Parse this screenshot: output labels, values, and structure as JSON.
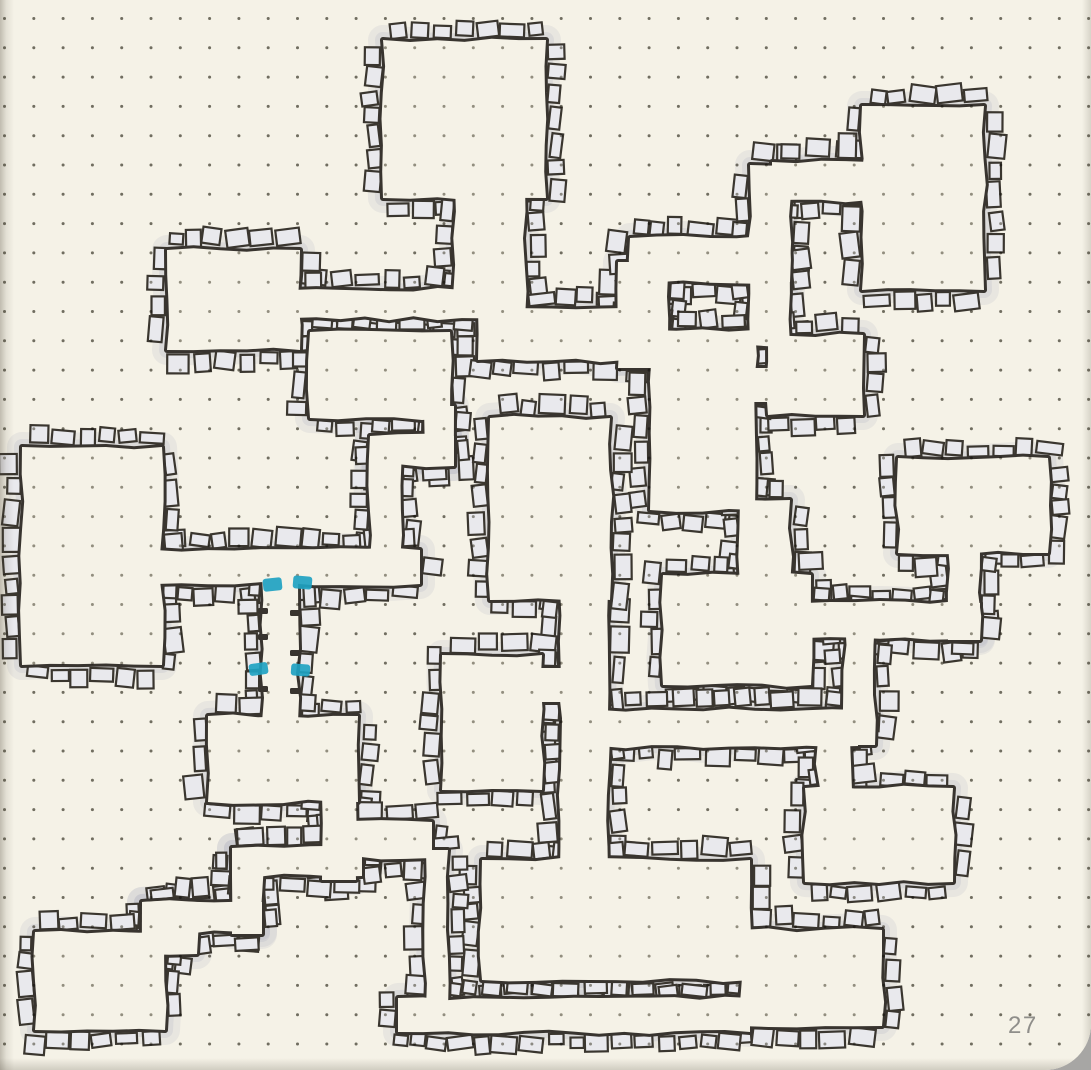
{
  "page": {
    "number": "27"
  },
  "canvas": {
    "width": 1091,
    "height": 1070
  },
  "colors": {
    "paper": "#f5f2e7",
    "ink": "#38342f",
    "stone_fill": "#e9e9ed",
    "stone_edge": "#3a362f",
    "halo": "#a9a9bc",
    "dot": "#8d8b80",
    "door_teal": "#1ea2c2",
    "page_number": "#8f8e8a",
    "surround": "#a7a6a4"
  },
  "dot_grid": {
    "start_x": 4.5,
    "start_y": 18.5,
    "spacing": 29.3,
    "dot_radius": 1.5
  },
  "map": {
    "spaces": [
      {
        "name": "room-top-center",
        "rect": [
          383,
          40,
          163,
          158
        ]
      },
      {
        "name": "corr-top-down",
        "rect": [
          455,
          185,
          70,
          133
        ]
      },
      {
        "name": "corr-west-link",
        "rect": [
          292,
          290,
          170,
          28
        ]
      },
      {
        "name": "room-upper-left",
        "rect": [
          167,
          250,
          133,
          100
        ]
      },
      {
        "name": "room-mid-left",
        "rect": [
          310,
          332,
          140,
          86
        ]
      },
      {
        "name": "corr-ml-down",
        "rect": [
          424,
          406,
          30,
          60
        ]
      },
      {
        "name": "corr-ml-west",
        "rect": [
          370,
          436,
          84,
          30
        ]
      },
      {
        "name": "corr-ml-down2",
        "rect": [
          370,
          436,
          30,
          124
        ]
      },
      {
        "name": "corr-left",
        "rect": [
          155,
          550,
          265,
          34
        ]
      },
      {
        "name": "room-left-big",
        "rect": [
          22,
          447,
          140,
          218
        ]
      },
      {
        "name": "corr-teal-doors",
        "rect": [
          262,
          576,
          36,
          146
        ]
      },
      {
        "name": "room-small-bottom",
        "rect": [
          208,
          716,
          150,
          86
        ]
      },
      {
        "name": "corr-east",
        "rect": [
          478,
          308,
          147,
          52
        ]
      },
      {
        "name": "corr-ne-vert",
        "rect": [
          618,
          262,
          38,
          106
        ]
      },
      {
        "name": "corr-ne-horiz",
        "rect": [
          630,
          238,
          160,
          44
        ]
      },
      {
        "name": "conn-ne-room",
        "rect": [
          632,
          275,
          36,
          65
        ]
      },
      {
        "name": "corr-topright-vert",
        "rect": [
          750,
          165,
          40,
          180
        ]
      },
      {
        "name": "corr-topright-horiz",
        "rect": [
          772,
          162,
          98,
          38
        ]
      },
      {
        "name": "room-top-right",
        "rect": [
          862,
          106,
          122,
          184
        ]
      },
      {
        "name": "room-ne-mid",
        "rect": [
          650,
          330,
          105,
          180
        ]
      },
      {
        "name": "room-ne-east",
        "rect": [
          768,
          335,
          95,
          80
        ]
      },
      {
        "name": "conn-ne-east",
        "rect": [
          745,
          368,
          30,
          34
        ]
      },
      {
        "name": "conn-ne-south",
        "rect": [
          740,
          500,
          50,
          85
        ]
      },
      {
        "name": "room-mid-right",
        "rect": [
          663,
          575,
          148,
          110
        ]
      },
      {
        "name": "corr-mr-east",
        "rect": [
          805,
          603,
          175,
          35
        ]
      },
      {
        "name": "corr-right-vert",
        "rect": [
          845,
          620,
          30,
          125
        ]
      },
      {
        "name": "corr-rm-down",
        "rect": [
          948,
          545,
          32,
          95
        ]
      },
      {
        "name": "room-right",
        "rect": [
          898,
          458,
          150,
          95
        ]
      },
      {
        "name": "corr-mid-horiz",
        "rect": [
          600,
          710,
          258,
          36
        ]
      },
      {
        "name": "corr-central-vert",
        "rect": [
          560,
          590,
          48,
          282
        ]
      },
      {
        "name": "room-central",
        "rect": [
          490,
          418,
          120,
          182
        ]
      },
      {
        "name": "room-below-central",
        "rect": [
          442,
          655,
          100,
          135
        ]
      },
      {
        "name": "conn-below-central",
        "rect": [
          535,
          668,
          32,
          34
        ]
      },
      {
        "name": "corr-right-link",
        "rect": [
          818,
          740,
          32,
          72
        ]
      },
      {
        "name": "room-bottom-right-upper",
        "rect": [
          805,
          788,
          148,
          94
        ]
      },
      {
        "name": "room-long-bottom",
        "rect": [
          482,
          860,
          268,
          120
        ]
      },
      {
        "name": "room-bottom-right-lower",
        "rect": [
          740,
          930,
          142,
          96
        ]
      },
      {
        "name": "corr-smallroom-down",
        "rect": [
          322,
          795,
          34,
          85
        ]
      },
      {
        "name": "corr-bl-horiz",
        "rect": [
          330,
          822,
          102,
          36
        ]
      },
      {
        "name": "corr-bl-vert",
        "rect": [
          426,
          850,
          22,
          160
        ]
      },
      {
        "name": "corr-bottom",
        "rect": [
          398,
          998,
          352,
          34
        ]
      },
      {
        "name": "zig-step1",
        "rect": [
          142,
          902,
          55,
          52
        ]
      },
      {
        "name": "zig-step2",
        "rect": [
          142,
          902,
          120,
          30
        ]
      },
      {
        "name": "zig-step3",
        "rect": [
          232,
          848,
          30,
          86
        ]
      },
      {
        "name": "zig-step4",
        "rect": [
          232,
          848,
          130,
          28
        ]
      },
      {
        "name": "room-bottom-left",
        "rect": [
          35,
          932,
          130,
          98
        ]
      }
    ],
    "doors": [
      {
        "name": "teal-door-upper-left",
        "rect": [
          263,
          578,
          19,
          13
        ],
        "rot": -6
      },
      {
        "name": "teal-door-upper-right",
        "rect": [
          293,
          576,
          19,
          13
        ],
        "rot": 5
      },
      {
        "name": "teal-door-lower-left",
        "rect": [
          249,
          663,
          19,
          12
        ],
        "rot": -8
      },
      {
        "name": "teal-door-lower-right",
        "rect": [
          291,
          664,
          19,
          12
        ],
        "rot": 4
      }
    ],
    "wall_ticks": [
      [
        258,
        608,
        10,
        6
      ],
      [
        258,
        634,
        10,
        6
      ],
      [
        258,
        686,
        10,
        6
      ],
      [
        290,
        610,
        10,
        6
      ],
      [
        290,
        650,
        10,
        6
      ],
      [
        290,
        688,
        10,
        6
      ]
    ]
  }
}
